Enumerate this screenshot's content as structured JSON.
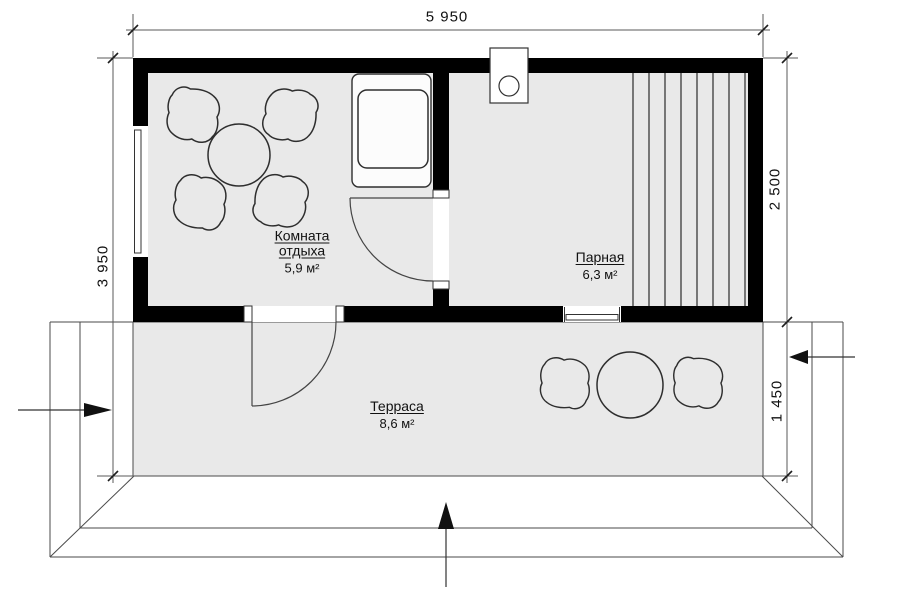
{
  "plan": {
    "dimensions": {
      "width_total": "5 950",
      "depth_total": "3 950",
      "depth_main": "2 500",
      "depth_terrace": "1 450"
    },
    "rooms": {
      "rest_room": {
        "name_line1": "Комната",
        "name_line2": "отдыха",
        "area": "5,9 м²"
      },
      "steam_room": {
        "name": "Парная",
        "area": "6,3 м²"
      },
      "terrace": {
        "name": "Терраса",
        "area": "8,6 м²"
      }
    },
    "icons": {
      "entrance_arrow_bottom": "arrow-up",
      "entrance_arrow_left": "arrow-right",
      "entrance_arrow_right": "arrow-left",
      "stove": "sauna-stove-with-chimney-circle"
    },
    "colors": {
      "wall": "#000000",
      "floor": "#e9e9e9",
      "line": "#4a4a4a",
      "furniture": "#2e2e2e",
      "background": "#ffffff"
    }
  }
}
